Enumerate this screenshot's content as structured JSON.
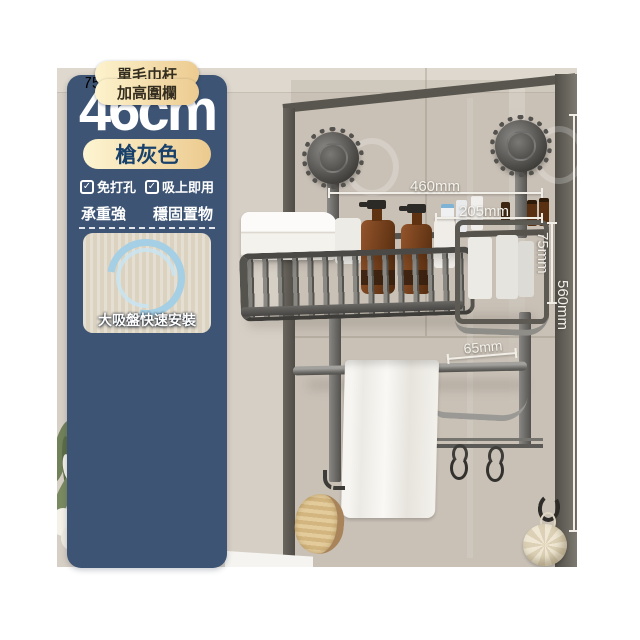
{
  "panel": {
    "size": "46cm",
    "color_name": "槍灰色",
    "features_checked": [
      "免打孔",
      "吸上即用"
    ],
    "selling_points": [
      "承重強",
      "穩固置物"
    ],
    "cards": [
      {
        "caption": "大吸盤快速安裝"
      },
      {
        "caption": "單毛巾杆"
      },
      {
        "caption": "加高圍欄",
        "measure_labels": [
          "750mm",
          "500mm"
        ]
      }
    ]
  },
  "photo": {
    "dimension_labels": {
      "top_width": "460mm",
      "inner_width": "205mm",
      "basket_height": "75mm",
      "total_height": "560mm",
      "hook_offset": "65mm"
    }
  },
  "icons": {
    "check": "✓"
  },
  "colors": {
    "panel_navy": "#3d5474",
    "gold_light": "#fdf5d2",
    "gold_dark": "#ecca8e",
    "pill_text_navy": "#17406b",
    "wall_beige": "#d6cfc5",
    "glass_frame_gray": "#56534c",
    "metal_gun_gray": "#6f6d69",
    "amber_bottle": "#8a4c26",
    "annotation_white": "#f1eee8",
    "measure_tag_blue": "#5fa9cc"
  }
}
